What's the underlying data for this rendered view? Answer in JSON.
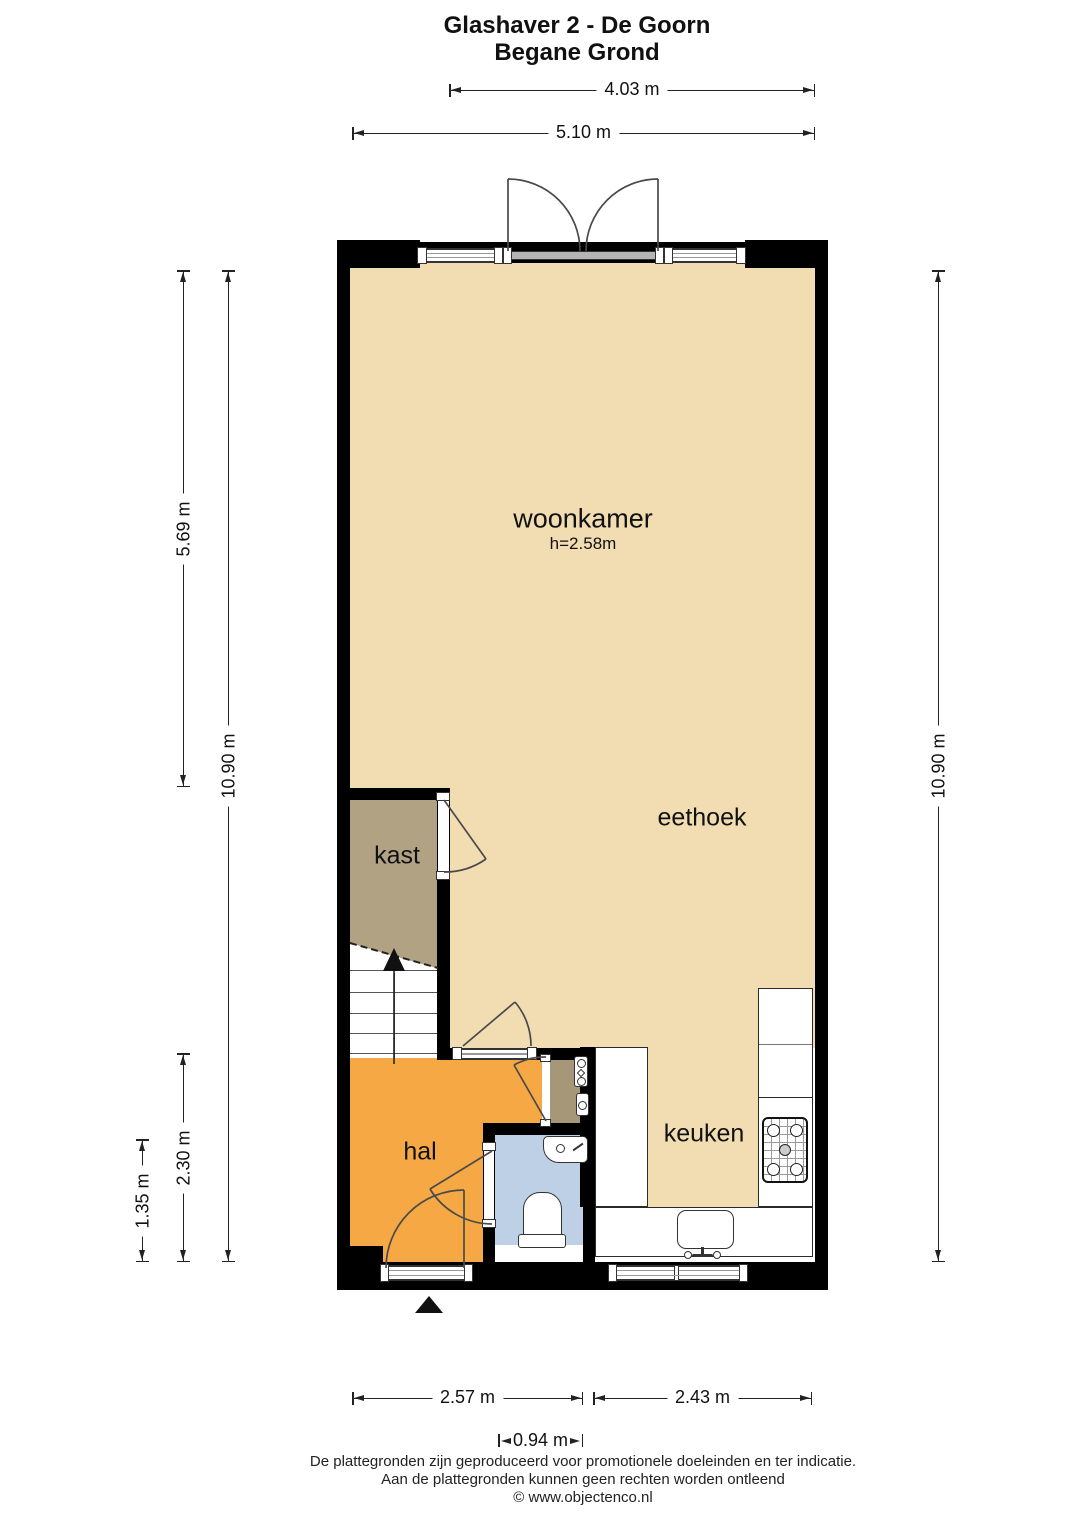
{
  "title": {
    "line1": "Glashaver 2 - De Goorn",
    "line2": "Begane Grond"
  },
  "floorplan": {
    "rooms": {
      "woonkamer": {
        "label": "woonkamer",
        "ceiling_height": "h=2.58m"
      },
      "eethoek": {
        "label": "eethoek"
      },
      "kast": {
        "label": "kast"
      },
      "hal": {
        "label": "hal"
      },
      "keuken": {
        "label": "keuken"
      }
    },
    "icons": {
      "entrance_marker": "filled-triangle-up",
      "stairs_direction": "arrow-up",
      "fixtures": [
        "stairs",
        "toilet",
        "hand-basin",
        "kitchen-sink",
        "gas-hob",
        "utility-meters",
        "door-swing-arcs",
        "french-doors",
        "windows"
      ]
    }
  },
  "dimensions": {
    "top_inner": "4.03 m",
    "top_outer": "5.10 m",
    "left_upper": "5.69 m",
    "left_total": "10.90 m",
    "left_hal": "2.30 m",
    "left_toilet": "1.35 m",
    "right_total": "10.90 m",
    "bottom_left": "2.57 m",
    "bottom_right": "2.43 m",
    "bottom_toilet": "0.94 m"
  },
  "footer": {
    "line1": "De plattegronden zijn geproduceerd voor promotionele doeleinden en ter indicatie.",
    "line2": "Aan de plattegronden kunnen geen rechten worden ontleend",
    "line3": "© www.objectenco.nl"
  },
  "colors": {
    "floor": "#F2DDB3",
    "kast": "#B1A284",
    "meterkast": "#A69778",
    "hal": "#F6A845",
    "toilet": "#BDD0E5",
    "wall": "#000000",
    "line": "#222222"
  }
}
